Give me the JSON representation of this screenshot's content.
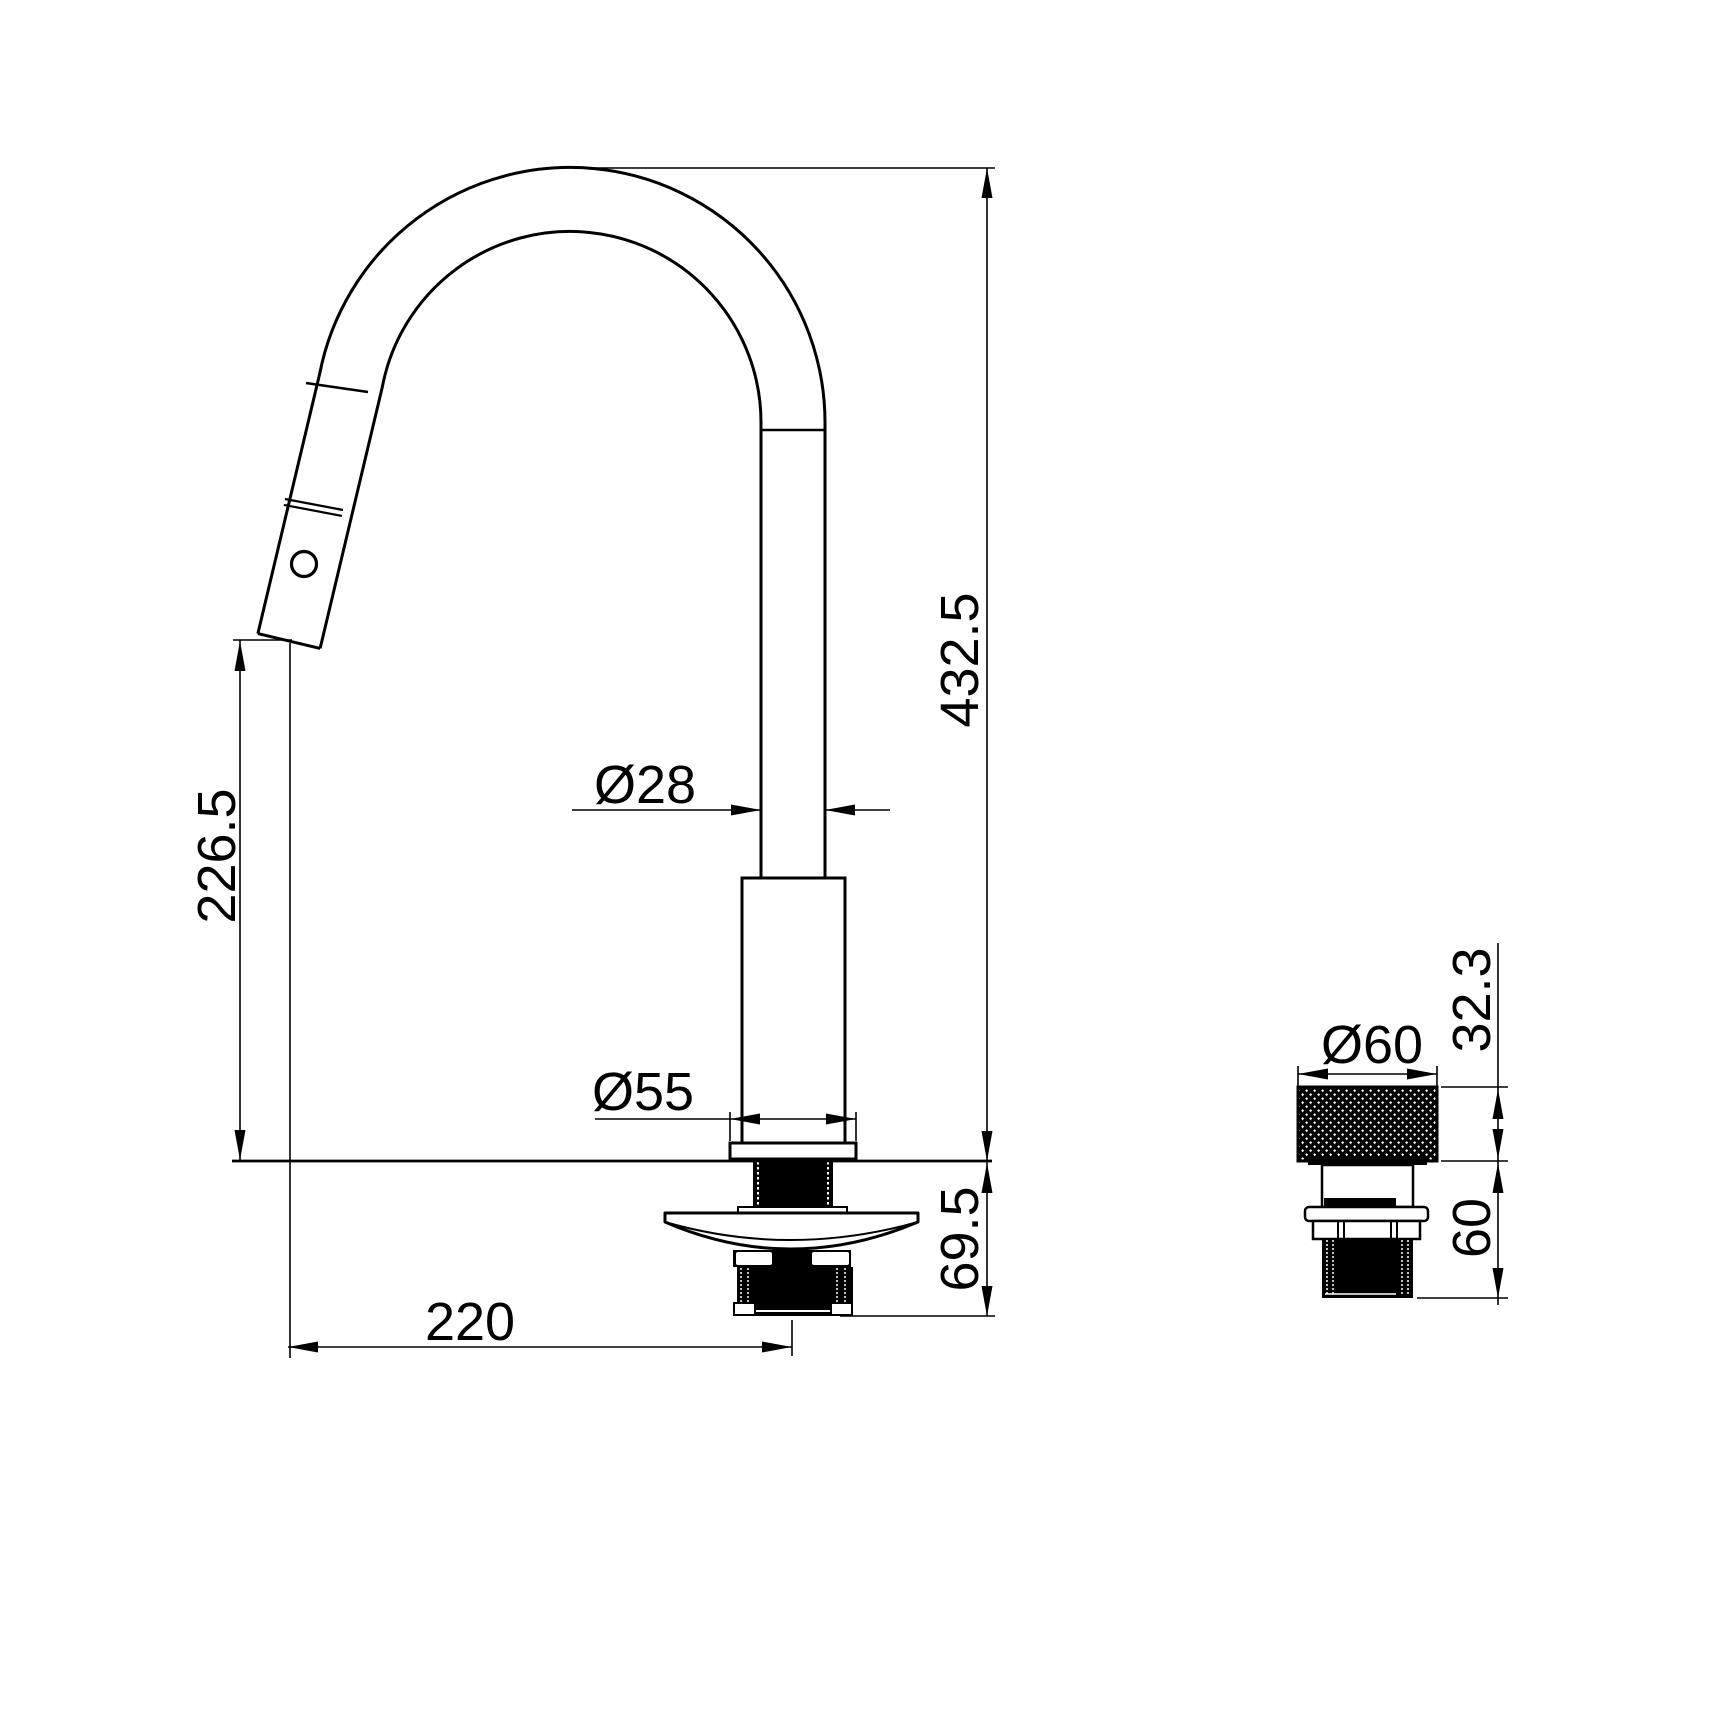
{
  "colors": {
    "background": "#ffffff",
    "line": "#000000"
  },
  "drawing_type": "faucet-installation-dimension-drawing",
  "views": {
    "main_view": {
      "name": "pull-out-kitchen-faucet-side-elevation",
      "dimensions": {
        "overall_height": "432.5",
        "spout_outlet_height": "226.5",
        "spout_tube_diameter": "Ø28",
        "base_flange_diameter": "Ø55",
        "below_deck_depth": "69.5",
        "spout_reach": "220"
      }
    },
    "detail_view": {
      "name": "remote-control-handle-detail",
      "dimensions": {
        "handle_diameter": "Ø60",
        "handle_height": "32.3",
        "handle_below_deck_depth": "60"
      }
    }
  }
}
